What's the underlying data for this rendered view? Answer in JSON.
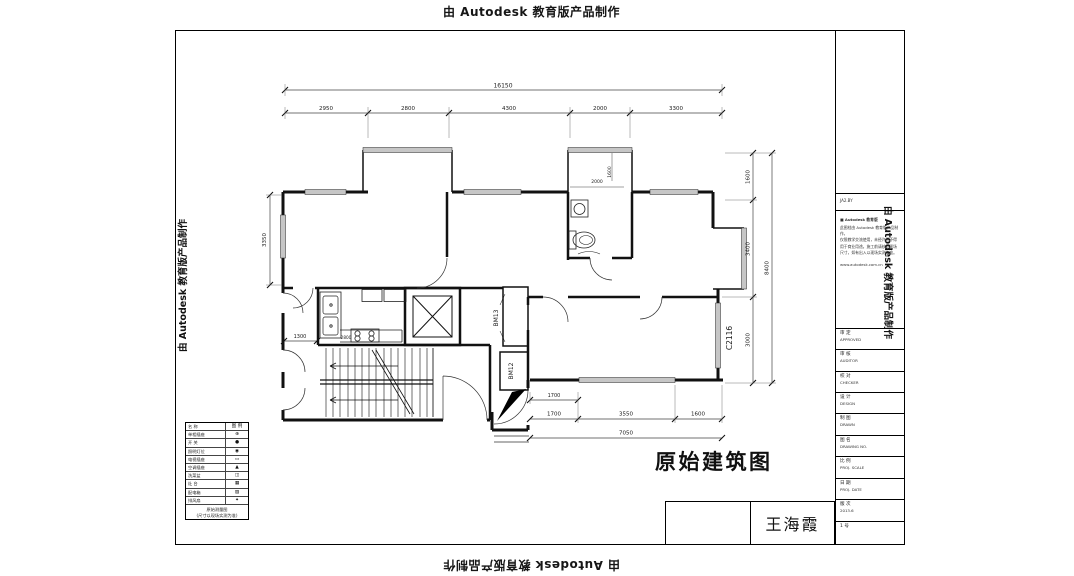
{
  "watermark": {
    "text": "由 Autodesk 教育版产品制作"
  },
  "title": "原始建筑图",
  "signature": "王海霞",
  "dims": {
    "top_total": "16150",
    "top_segments": [
      "2950",
      "2800",
      "4300",
      "2000",
      "3300"
    ],
    "left_room": "3350",
    "left_small": "1300",
    "right_segments": [
      "1600",
      "3400",
      "3000"
    ],
    "right_total": "8400",
    "bottom_upper": "1700",
    "bottom_segments": [
      "1700",
      "3550",
      "1600"
    ],
    "bottom_total": "7050",
    "bath_width": "2000",
    "bath_height": "1600",
    "kitchen_small": "2800"
  },
  "labels": {
    "duct_upper": "BM13",
    "duct_lower": "BM12",
    "window_right": "C2116"
  },
  "legend": {
    "rows": [
      {
        "name": "名 称",
        "sym": "图 例"
      },
      {
        "name": "单相插座",
        "sym": "⊕"
      },
      {
        "name": "开 关",
        "sym": "●"
      },
      {
        "name": "照明灯位",
        "sym": "◉"
      },
      {
        "name": "电视插座",
        "sym": "▭"
      },
      {
        "name": "空调插座",
        "sym": "▲"
      },
      {
        "name": "洗菜盆",
        "sym": "◫"
      },
      {
        "name": "灶 台",
        "sym": "▦"
      },
      {
        "name": "配电箱",
        "sym": "▨"
      },
      {
        "name": "排风扇",
        "sym": "✦"
      }
    ],
    "footer_line1": "原始测量图",
    "footer_line2": "(尺寸以现场实测为准)"
  },
  "titleblock": {
    "code_cell": "JA2.BY",
    "notes": [
      "■ Autodesk 教育版",
      "此图档由 Autodesk 教育版产品制作，",
      "仅限教学交流使用，未经许可不得",
      "用于商业用途。施工前请核对现场",
      "尺寸，如有出入以现场实测为准。",
      "www.autodesk.com.cn"
    ],
    "rows": [
      {
        "cn": "审 定",
        "en": "APPROVED"
      },
      {
        "cn": "审 核",
        "en": "AUDITOR"
      },
      {
        "cn": "校 对",
        "en": "CHECKER"
      },
      {
        "cn": "设 计",
        "en": "DESIGN"
      },
      {
        "cn": "制 图",
        "en": "DRAWN"
      },
      {
        "cn": "图 名",
        "en": "DRAWING NO."
      },
      {
        "cn": "比 例",
        "en": "PROJ. SCALE"
      },
      {
        "cn": "日 期",
        "en": "PROJ. DATE"
      },
      {
        "cn": "版 次",
        "en": "2013.6"
      },
      {
        "cn": "1 号",
        "en": ""
      }
    ]
  }
}
